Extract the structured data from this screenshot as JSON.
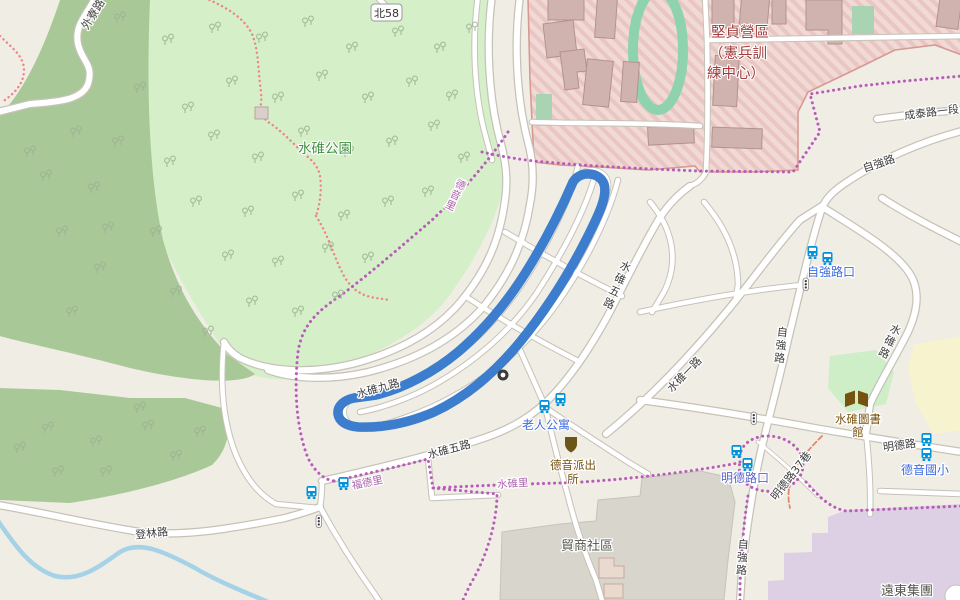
{
  "map": {
    "labels": {
      "park": "水碓公園",
      "route_ref": "北58",
      "military": {
        "line1": "堅貞營區",
        "line2": "（憲兵訓",
        "line3": "練中心）"
      },
      "roads": {
        "wailiao": "外寮路",
        "chengtai": "成泰路一段",
        "ziqiang": "自強路",
        "shuidui": "水碓路",
        "mingde": "明德路",
        "mingde_lane37": "明德路37巷",
        "shuidui9": "水碓九路",
        "shuidui5": "水碓五路",
        "shuidui1": "水碓一路",
        "denglin": "登林路"
      },
      "stops": {
        "elder_apartment": "老人公寓",
        "ziqiang_intersection": "自強路口",
        "mingde_intersection": "明德路口",
        "deyin_school": "德音國小"
      },
      "villages": {
        "deyin": "德音里",
        "fude": "福德里",
        "shuidui": "水碓里"
      },
      "pois": {
        "library1": "水碓圖書",
        "library2": "館",
        "police1": "德音派出",
        "police2": "所",
        "maoshang": "貿商社區",
        "fareast": "遠東集團"
      }
    },
    "icons": {
      "bus": "bus-stop-icon",
      "traffic_light": "traffic-signals-icon",
      "police": "police-station-icon",
      "library": "library-book-icon",
      "mini_roundabout": "mini-roundabout-icon",
      "trees": "tree-pair-icon",
      "route_shield": "road-ref-shield"
    },
    "colors": {
      "route_blue": "#3c7dcd",
      "park_green": "#d5f0c9",
      "wood_green": "#a9c897",
      "military_pink": "#f1d9d5",
      "military_border": "#d79a93",
      "track_green": "#8fd3ae",
      "water_blue": "#a6d2e8",
      "boundary_purple": "#b75cb8",
      "stop_label_blue": "#3d6be0",
      "poi_brown": "#75520e",
      "estate_grey": "#d8d5cd",
      "commercial_lavender": "#ded0e4",
      "school_yellow": "#f8f3cf",
      "road_casing": "#c6c2b8"
    }
  }
}
